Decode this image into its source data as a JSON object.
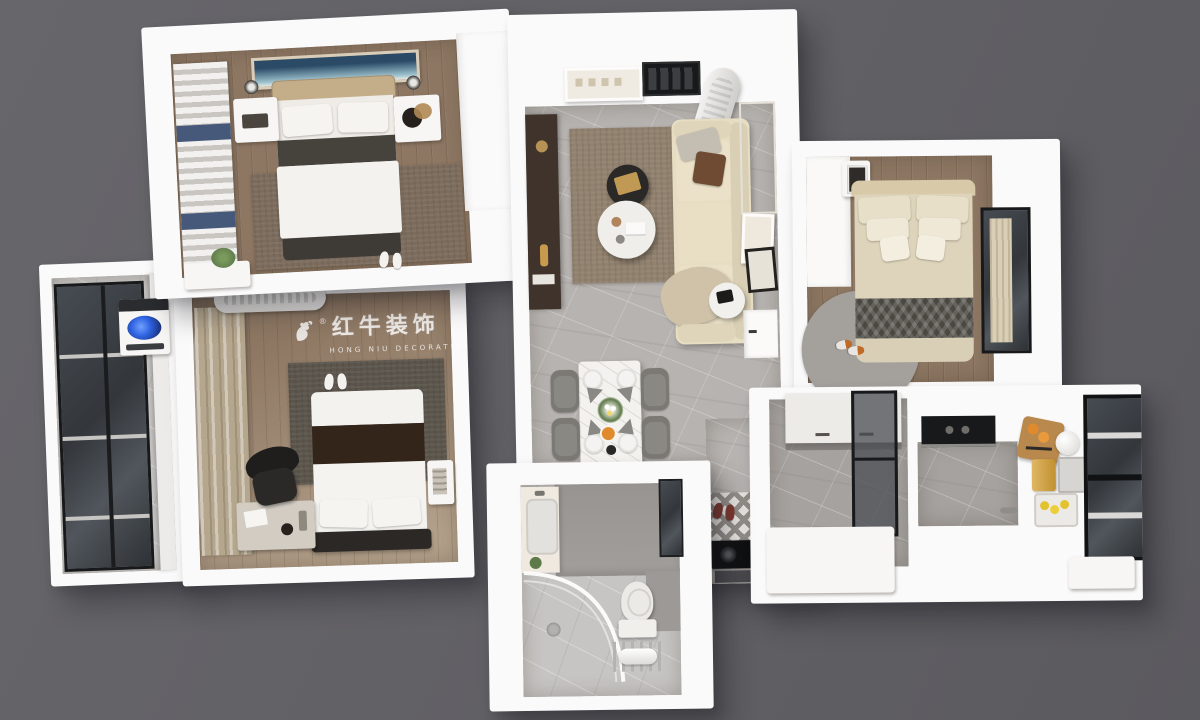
{
  "scene": {
    "kind": "top-down 3D interior render of a two-bedroom apartment floor plan",
    "background": "#616065"
  },
  "watermark": {
    "brand": "红牛装饰",
    "subtitle": "HONG NIU DECORATION",
    "registered": "®",
    "logo": "bull-swoosh-icon",
    "color": "rgba(255,255,255,0.8)"
  },
  "palette": {
    "wall": "#fbfafa",
    "wood": "#8d7763",
    "woodLight": "#b3a08a",
    "marble": "#b7b3b0",
    "tileGray": "#a29e9b",
    "tileLight": "#c7c5c3",
    "rugBrown": "#91816e",
    "rugBrown2": "#7c6c5d",
    "rugDark": "#5b554c",
    "rugRound": "#a4a19d",
    "sofaCream": "#e6ddc2",
    "bedBeige": "#c4ae8a",
    "beddingBeige": "#ded4bb",
    "duvetWhite": "#f3f2ef",
    "darkStrip": "#46423c",
    "brownStrip": "#34251a",
    "chevronDark": "#4b4841",
    "patternGray": "#938f8a",
    "frameBlack": "#17191b",
    "glassDark": "#3b4046",
    "curtainTan": "#b5a78e",
    "curtainBeige": "#d9cfb6",
    "navy": "#46597a",
    "chairGray": "#7b7974",
    "chairGray2": "#8a8883",
    "accentOrange": "#e08a2e",
    "slipperOrange": "#c06a28",
    "redSlipper": "#7e3930",
    "lemonYellow": "#e3c22e",
    "gold": "#c19030",
    "washerBlue": "#2f62e0",
    "artBlue": "#2a4a66",
    "tvCabinet": "#3f332b",
    "plantGreen": "#5e7a4a"
  },
  "rooms": [
    {
      "id": "master-bedroom",
      "position": "top-left",
      "furniture": [
        "double-bed",
        "headboard",
        "pillows",
        "dark-runner",
        "nightstand-left",
        "table-lamp-left",
        "nightstand-right",
        "table-lamp-right",
        "seascape-wall-art",
        "striped-roman-curtain",
        "area-rug",
        "wardrobe",
        "radiator-bench",
        "potted-plant",
        "white-slippers"
      ]
    },
    {
      "id": "living-dining-room",
      "position": "center",
      "furniture": [
        "cream-sectional-sofa",
        "throw-blanket",
        "toss-cushions",
        "round-coffee-table-dark",
        "round-coffee-table-white",
        "area-rug",
        "tv-cabinet",
        "wall-art",
        "ceiling-vent",
        "portable-ac-unit",
        "window-blinds",
        "leaning-picture-frames",
        "round-side-table",
        "interior-door",
        "marble-dining-table",
        "dining-chairs-x4",
        "plates-napkins",
        "flower-centerpiece",
        "orange-juice",
        "diamond-door-mat",
        "red-slippers",
        "gas-cooktop"
      ]
    },
    {
      "id": "second-bedroom",
      "position": "top-right",
      "furniture": [
        "double-bed",
        "chevron-blanket",
        "pillow-stack",
        "nightstand",
        "round-rug",
        "orange-slippers",
        "window-with-curtain",
        "built-in-cabinet"
      ]
    },
    {
      "id": "balcony",
      "position": "left",
      "furniture": [
        "floor-to-ceiling-windows",
        "washing-machine",
        "ledge"
      ]
    },
    {
      "id": "third-bedroom",
      "position": "bottom-left",
      "furniture": [
        "double-bed",
        "brown-runner",
        "pillows",
        "wall-ac-unit",
        "wavy-curtains",
        "bright-window",
        "dark-area-rug",
        "desk",
        "office-chair",
        "side-table",
        "white-slippers",
        "brand-watermark"
      ]
    },
    {
      "id": "bathroom",
      "position": "bottom-center",
      "furniture": [
        "vanity-with-sink",
        "curved-glass-shower",
        "toilet",
        "towel-rack",
        "small-window",
        "potted-plant"
      ]
    },
    {
      "id": "kitchen",
      "position": "right",
      "furniture": [
        "wall-cabinets",
        "glass-partition-door",
        "range-hood",
        "countertop",
        "cutting-board-with-oranges",
        "kettle",
        "gold-canister",
        "metal-tray",
        "lemon-basket",
        "large-black-frame-window",
        "island-counter"
      ]
    }
  ]
}
